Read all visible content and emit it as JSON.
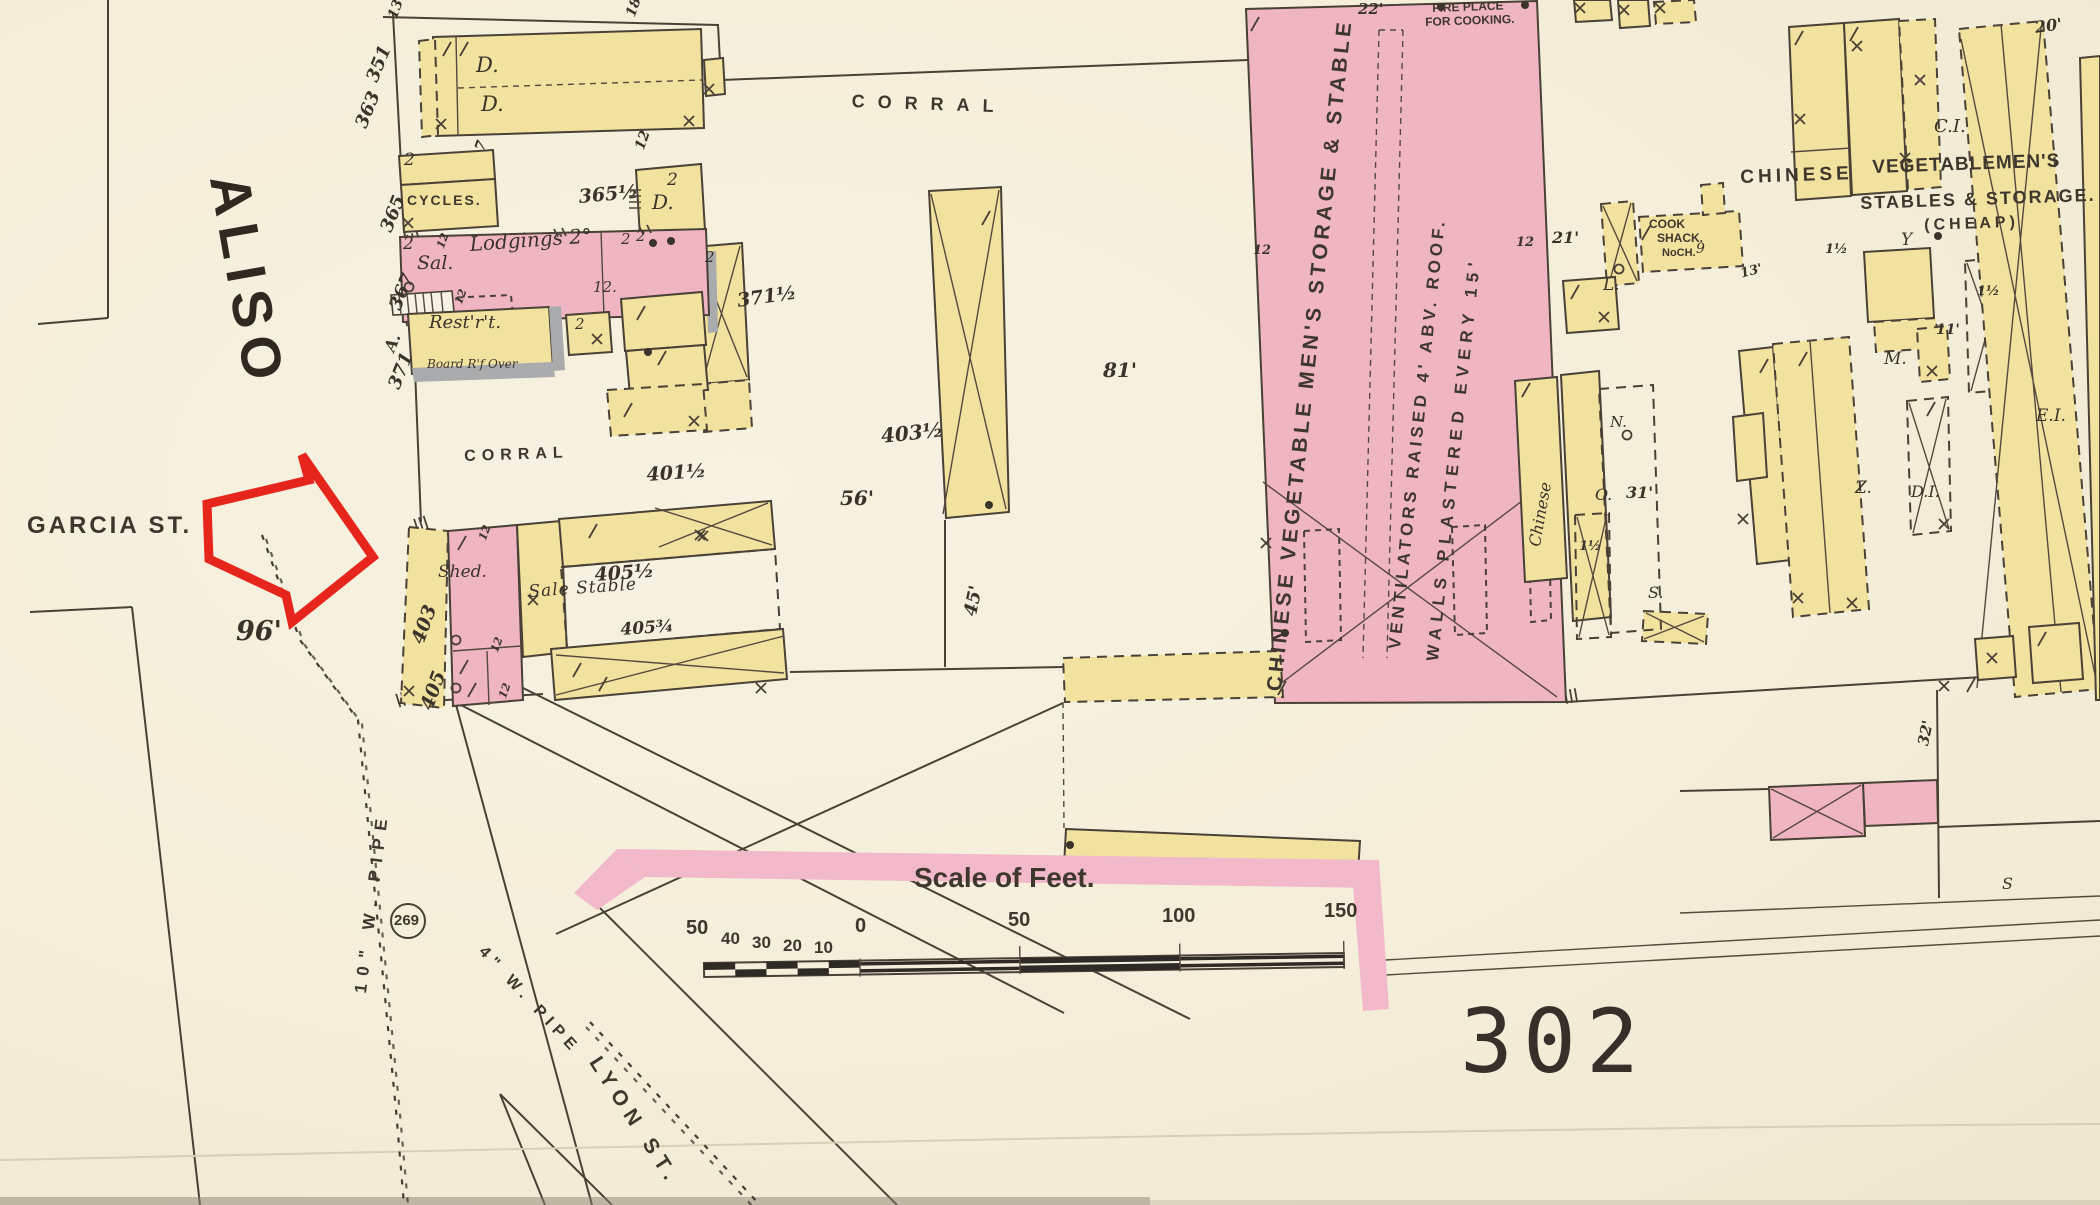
{
  "map": {
    "title_hint": "Sanborn insurance map sheet",
    "sheet_number": "302",
    "colors": {
      "paper": "#f5efdf",
      "building_yellow": "#f2e2a0",
      "building_pink": "#f0b5c3",
      "block_edge_band": "#f2b9ca",
      "ink": "#4a4136",
      "annotation_red": "#e6261c",
      "iron_grey": "#a9abad"
    },
    "scale_bar": {
      "title": "Scale of Feet.",
      "left_ticks": [
        "50",
        "40",
        "30",
        "20",
        "10",
        "0"
      ],
      "main_ticks": [
        "50",
        "100",
        "150"
      ]
    },
    "streets": {
      "west": "ALISO",
      "side": "GARCIA ST.",
      "south": "LYON ST."
    },
    "utilities": {
      "main_pipe": "10\" W. PIPE",
      "branch_pipe": "4\" W. PIPE",
      "hydrant_number": "269"
    }
  },
  "labels": [
    {
      "n": "street-aliso",
      "t": "ALISO",
      "x": 256,
      "y": 170,
      "s": 56,
      "r": 80,
      "ls": 9,
      "f": "blk2"
    },
    {
      "n": "street-garcia",
      "t": "GARCIA ST.",
      "x": 27,
      "y": 514,
      "s": 24,
      "ls": 3,
      "f": "blk"
    },
    {
      "n": "street-lyon",
      "t": "LYON ST.",
      "x": 603,
      "y": 1053,
      "s": 21,
      "r": 57,
      "ls": 7,
      "f": "blk"
    },
    {
      "n": "dim-96",
      "t": "96'",
      "x": 236,
      "y": 618,
      "s": 27
    },
    {
      "n": "sheet-number",
      "t": "302",
      "x": 1460,
      "y": 998,
      "s": 88,
      "ls": 10,
      "f": "big"
    },
    {
      "n": "scale-title",
      "t": "Scale of Feet.",
      "x": 914,
      "y": 864,
      "s": 28,
      "f": "blk"
    },
    {
      "n": "scale-50l",
      "t": "50",
      "x": 686,
      "y": 918,
      "s": 20,
      "f": "blk"
    },
    {
      "n": "scale-40",
      "t": "40",
      "x": 721,
      "y": 930,
      "s": 17,
      "f": "blk"
    },
    {
      "n": "scale-30",
      "t": "30",
      "x": 752,
      "y": 934,
      "s": 17,
      "f": "blk"
    },
    {
      "n": "scale-20",
      "t": "20",
      "x": 783,
      "y": 937,
      "s": 17,
      "f": "blk"
    },
    {
      "n": "scale-10",
      "t": "10",
      "x": 814,
      "y": 939,
      "s": 17,
      "f": "blk"
    },
    {
      "n": "scale-0",
      "t": "0",
      "x": 855,
      "y": 916,
      "s": 20,
      "f": "blk"
    },
    {
      "n": "scale-50",
      "t": "50",
      "x": 1008,
      "y": 910,
      "s": 20,
      "f": "blk"
    },
    {
      "n": "scale-100",
      "t": "100",
      "x": 1162,
      "y": 906,
      "s": 20,
      "f": "blk"
    },
    {
      "n": "scale-150",
      "t": "150",
      "x": 1324,
      "y": 901,
      "s": 20,
      "f": "blk"
    },
    {
      "n": "hydrant-269",
      "t": "269",
      "x": 394,
      "y": 913,
      "s": 15,
      "f": "blk"
    },
    {
      "n": "pipe-10in",
      "t": "10\" W. PIPE",
      "x": 352,
      "y": 992,
      "s": 17,
      "r": -83,
      "ls": 8,
      "f": "blk"
    },
    {
      "n": "pipe-4in",
      "t": "4\" W. PIPE",
      "x": 487,
      "y": 944,
      "s": 16,
      "r": 47,
      "ls": 6,
      "f": "blk"
    },
    {
      "n": "dim-13",
      "t": "13",
      "x": 386,
      "y": 16,
      "s": 14,
      "r": -70
    },
    {
      "n": "dim-18",
      "t": "18",
      "x": 624,
      "y": 14,
      "s": 14,
      "r": -70
    },
    {
      "n": "bldg-dwelling-1",
      "t": "D.",
      "x": 476,
      "y": 55,
      "s": 21,
      "f": "scr"
    },
    {
      "n": "bldg-dwelling-2",
      "t": "D.",
      "x": 481,
      "y": 94,
      "s": 21,
      "f": "scr"
    },
    {
      "n": "dim-7",
      "t": "7",
      "x": 473,
      "y": 148,
      "s": 14,
      "r": -70
    },
    {
      "n": "dim-12a",
      "t": "12",
      "x": 633,
      "y": 147,
      "s": 14,
      "r": -70
    },
    {
      "n": "addr-351",
      "t": "351",
      "x": 364,
      "y": 78,
      "s": 18,
      "r": -68
    },
    {
      "n": "addr-363",
      "t": "363",
      "x": 353,
      "y": 124,
      "s": 18,
      "r": -68
    },
    {
      "n": "story-2a",
      "t": "2",
      "x": 404,
      "y": 152,
      "s": 17,
      "f": "scr"
    },
    {
      "n": "bldg-cycles",
      "t": "CYCLES.",
      "x": 407,
      "y": 193,
      "s": 14,
      "ls": 2,
      "f": "blk"
    },
    {
      "n": "addr-365",
      "t": "365",
      "x": 378,
      "y": 228,
      "s": 18,
      "r": -68
    },
    {
      "n": "addr-365half",
      "t": "365½",
      "x": 578,
      "y": 188,
      "s": 19,
      "r": -5
    },
    {
      "n": "story-2b",
      "t": "2",
      "x": 667,
      "y": 172,
      "s": 17,
      "f": "scr"
    },
    {
      "n": "bldg-dwelling-3",
      "t": "D.",
      "x": 652,
      "y": 192,
      "s": 20,
      "f": "scr"
    },
    {
      "n": "story-2c",
      "t": "2",
      "x": 403,
      "y": 236,
      "s": 17,
      "f": "scr"
    },
    {
      "n": "bldg-saloon",
      "t": "Sal.",
      "x": 417,
      "y": 254,
      "s": 19,
      "f": "scr"
    },
    {
      "n": "bldg-lodgings",
      "t": "Lodgings 2°",
      "x": 469,
      "y": 234,
      "s": 20,
      "r": -4,
      "f": "scr"
    },
    {
      "n": "dim-12b",
      "t": "12.",
      "x": 593,
      "y": 280,
      "s": 15,
      "f": "scr"
    },
    {
      "n": "addr-367",
      "t": "367",
      "x": 387,
      "y": 306,
      "s": 18,
      "r": -68
    },
    {
      "n": "addr-A",
      "t": "A.",
      "x": 382,
      "y": 348,
      "s": 16,
      "r": -68
    },
    {
      "n": "addr-371",
      "t": "371",
      "x": 386,
      "y": 385,
      "s": 18,
      "r": -68
    },
    {
      "n": "story-2d",
      "t": "2",
      "x": 621,
      "y": 232,
      "s": 15,
      "f": "scr"
    },
    {
      "n": "story-2e",
      "t": "2",
      "x": 636,
      "y": 229,
      "s": 15,
      "f": "scr"
    },
    {
      "n": "story-2f",
      "t": "2",
      "x": 705,
      "y": 250,
      "s": 15,
      "f": "scr"
    },
    {
      "n": "bldg-restaurant",
      "t": "Rest'r't.",
      "x": 429,
      "y": 314,
      "s": 18,
      "f": "scr"
    },
    {
      "n": "note-board-roof",
      "t": "Board R'f Over",
      "x": 427,
      "y": 358,
      "s": 12,
      "f": "scr"
    },
    {
      "n": "story-2g",
      "t": "2",
      "x": 575,
      "y": 317,
      "s": 15,
      "f": "scr"
    },
    {
      "n": "addr-371half",
      "t": "371½",
      "x": 736,
      "y": 292,
      "s": 19,
      "r": -8
    },
    {
      "n": "area-corral-west",
      "t": "CORRAL",
      "x": 464,
      "y": 449,
      "s": 16,
      "ls": 6,
      "r": -2,
      "f": "blk"
    },
    {
      "n": "addr-401half",
      "t": "401½",
      "x": 646,
      "y": 466,
      "s": 19,
      "r": -4
    },
    {
      "n": "area-corral-north",
      "t": "CORRAL",
      "x": 852,
      "y": 92,
      "s": 18,
      "ls": 13,
      "r": 2,
      "f": "blk"
    },
    {
      "n": "bldg-shed",
      "t": "Shed.",
      "x": 438,
      "y": 564,
      "s": 17,
      "f": "scr"
    },
    {
      "n": "bldg-sale-stable",
      "t": "Sale Stable",
      "x": 528,
      "y": 584,
      "s": 17,
      "r": -4,
      "ls": 1,
      "f": "scr"
    },
    {
      "n": "addr-405half",
      "t": "405½",
      "x": 594,
      "y": 566,
      "s": 19,
      "r": -4
    },
    {
      "n": "addr-405threequarter",
      "t": "405¾",
      "x": 620,
      "y": 622,
      "s": 17,
      "r": -4
    },
    {
      "n": "addr-403",
      "t": "403",
      "x": 409,
      "y": 640,
      "s": 19,
      "r": -70
    },
    {
      "n": "addr-405",
      "t": "405",
      "x": 418,
      "y": 706,
      "s": 19,
      "r": -70
    },
    {
      "n": "addr-403half",
      "t": "403½",
      "x": 880,
      "y": 426,
      "s": 20,
      "r": -6
    },
    {
      "n": "dim-56",
      "t": "56'",
      "x": 840,
      "y": 488,
      "s": 20
    },
    {
      "n": "dim-81",
      "t": "81'",
      "x": 1103,
      "y": 360,
      "s": 20
    },
    {
      "n": "dim-45",
      "t": "45'",
      "x": 962,
      "y": 614,
      "s": 18,
      "r": -78
    },
    {
      "n": "dim-12c",
      "t": "12",
      "x": 477,
      "y": 538,
      "s": 11,
      "r": -70
    },
    {
      "n": "dim-12d",
      "t": "12",
      "x": 489,
      "y": 650,
      "s": 11,
      "r": -70
    },
    {
      "n": "dim-12e",
      "t": "12",
      "x": 497,
      "y": 696,
      "s": 11,
      "r": -70
    },
    {
      "n": "dim-12f",
      "t": "12",
      "x": 435,
      "y": 246,
      "s": 11,
      "r": -70
    },
    {
      "n": "dim-12g",
      "t": "12",
      "x": 453,
      "y": 302,
      "s": 11,
      "r": -70
    },
    {
      "n": "bldg-chinese-storage",
      "t": "CHINESE VEGETABLE MEN'S STORAGE & STABLE",
      "x": 1264,
      "y": 690,
      "s": 21,
      "r": -84,
      "ls": 4,
      "f": "blk"
    },
    {
      "n": "note-ventilators",
      "t": "VENTILATORS RAISED 4' ABV. ROOF.",
      "x": 1386,
      "y": 648,
      "s": 17,
      "r": -84,
      "ls": 4,
      "f": "blk"
    },
    {
      "n": "note-walls-plastered",
      "t": "WALLS PLASTERED EVERY 15'",
      "x": 1424,
      "y": 660,
      "s": 17,
      "r": -84,
      "ls": 6,
      "f": "blk"
    },
    {
      "n": "dim-22",
      "t": "22'",
      "x": 1358,
      "y": 2,
      "s": 15
    },
    {
      "n": "note-fireplace-1",
      "t": "FIRE PLACE",
      "x": 1432,
      "y": 2,
      "s": 12,
      "r": -2,
      "f": "blk"
    },
    {
      "n": "note-fireplace-2",
      "t": "FOR COOKING.",
      "x": 1425,
      "y": 16,
      "s": 12,
      "r": -2,
      "f": "blk"
    },
    {
      "n": "dim-12h",
      "t": "12",
      "x": 1253,
      "y": 244,
      "s": 13
    },
    {
      "n": "dim-12i",
      "t": "12",
      "x": 1516,
      "y": 236,
      "s": 13
    },
    {
      "n": "dim-21",
      "t": "21'",
      "x": 1552,
      "y": 230,
      "s": 16
    },
    {
      "n": "dim-20",
      "t": "20'",
      "x": 2034,
      "y": 20,
      "s": 16,
      "r": -8
    },
    {
      "n": "label-CI",
      "t": "C.I.",
      "x": 1934,
      "y": 118,
      "s": 18,
      "f": "scr"
    },
    {
      "n": "bldg-vegmen-1",
      "t": "CHINESE",
      "x": 1740,
      "y": 168,
      "s": 19,
      "ls": 4,
      "r": -2,
      "f": "blk"
    },
    {
      "n": "bldg-vegmen-2",
      "t": "VEGETABLEMEN'S",
      "x": 1872,
      "y": 158,
      "s": 19,
      "ls": 1,
      "r": -2,
      "f": "blk"
    },
    {
      "n": "bldg-vegmen-3",
      "t": "STABLES & STORAGE.",
      "x": 1860,
      "y": 194,
      "s": 18,
      "ls": 2,
      "r": -2,
      "f": "blk"
    },
    {
      "n": "bldg-vegmen-4",
      "t": "(CHEAP)",
      "x": 1924,
      "y": 218,
      "s": 16,
      "ls": 4,
      "r": -2,
      "f": "blk"
    },
    {
      "n": "bldg-cookshack-1",
      "t": "COOK",
      "x": 1649,
      "y": 218,
      "s": 12,
      "f": "blk"
    },
    {
      "n": "bldg-cookshack-2",
      "t": "SHACK.",
      "x": 1657,
      "y": 232,
      "s": 12,
      "f": "blk"
    },
    {
      "n": "bldg-cookshack-3",
      "t": "NoCH.",
      "x": 1662,
      "y": 248,
      "s": 11,
      "f": "blk"
    },
    {
      "n": "label-9",
      "t": "9",
      "x": 1696,
      "y": 242,
      "s": 14,
      "f": "scr"
    },
    {
      "n": "label-L",
      "t": "L.",
      "x": 1603,
      "y": 277,
      "s": 17,
      "f": "scr"
    },
    {
      "n": "label-Y",
      "t": "Y",
      "x": 1901,
      "y": 232,
      "s": 17,
      "f": "scr"
    },
    {
      "n": "dim-13b",
      "t": "13'",
      "x": 1739,
      "y": 268,
      "s": 13,
      "r": -15
    },
    {
      "n": "dim-11",
      "t": "11'",
      "x": 1936,
      "y": 323,
      "s": 14
    },
    {
      "n": "label-M",
      "t": "M.",
      "x": 1884,
      "y": 351,
      "s": 17,
      "f": "scr"
    },
    {
      "n": "label-N",
      "t": "N.",
      "x": 1610,
      "y": 415,
      "s": 15,
      "f": "scr"
    },
    {
      "n": "label-O",
      "t": "O.",
      "x": 1595,
      "y": 487,
      "s": 16,
      "f": "scr"
    },
    {
      "n": "dim-31",
      "t": "31'",
      "x": 1626,
      "y": 485,
      "s": 16
    },
    {
      "n": "bldg-chinese-small",
      "t": "Chinese",
      "x": 1527,
      "y": 545,
      "s": 16,
      "r": -80,
      "f": "scr"
    },
    {
      "n": "label-S",
      "t": "S.",
      "x": 1648,
      "y": 585,
      "s": 16,
      "f": "scr"
    },
    {
      "n": "dim-1half-a",
      "t": "1½",
      "x": 1825,
      "y": 243,
      "s": 13
    },
    {
      "n": "dim-1half-b",
      "t": "1½",
      "x": 1977,
      "y": 285,
      "s": 13
    },
    {
      "n": "dim-1half-c",
      "t": "1½",
      "x": 1579,
      "y": 540,
      "s": 13
    },
    {
      "n": "label-Z",
      "t": "Z.",
      "x": 1855,
      "y": 480,
      "s": 17,
      "f": "scr"
    },
    {
      "n": "label-DI",
      "t": "D.I.",
      "x": 1911,
      "y": 484,
      "s": 16,
      "f": "scr"
    },
    {
      "n": "label-EI",
      "t": "E.I.",
      "x": 2036,
      "y": 408,
      "s": 17,
      "f": "scr"
    },
    {
      "n": "dim-32",
      "t": "32'",
      "x": 1916,
      "y": 744,
      "s": 15,
      "r": -78
    },
    {
      "n": "label-S-edge",
      "t": "S",
      "x": 2002,
      "y": 876,
      "s": 16,
      "f": "scr"
    }
  ]
}
